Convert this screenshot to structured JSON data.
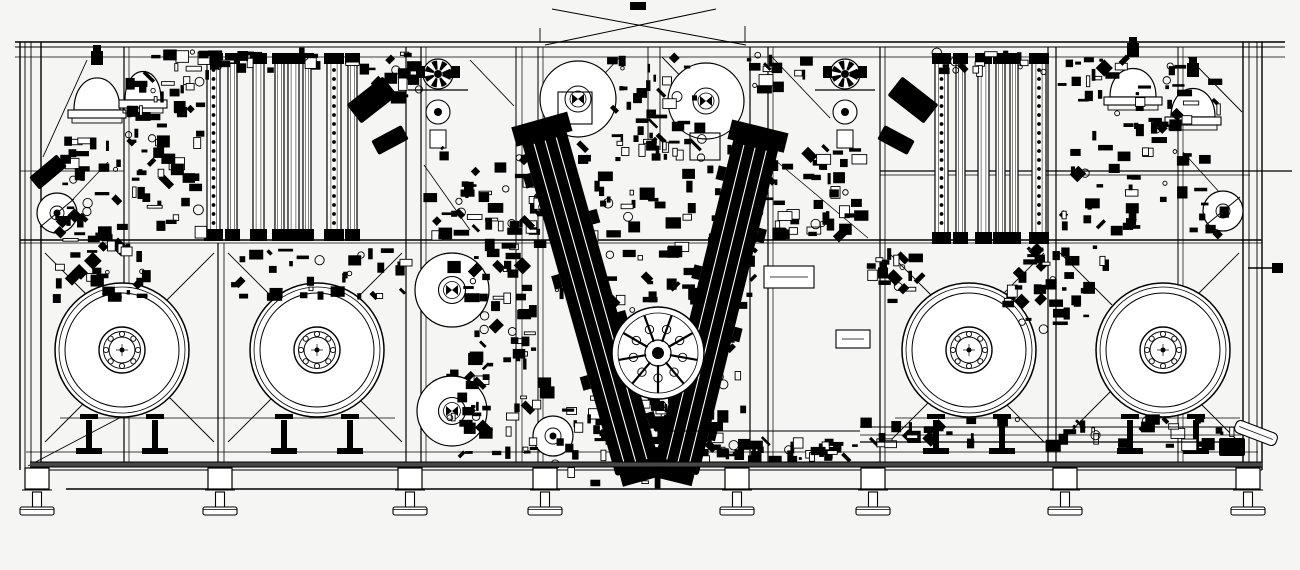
{
  "drawing": {
    "title": "machine-assembly-elevation-drawing",
    "canvas": {
      "w": 1300,
      "h": 570,
      "bg": "#f5f5f4",
      "ink": "#000000",
      "paper": "#ffffff",
      "beam": "#474747"
    },
    "frame": {
      "hlines": [
        [
          15,
          42,
          1285,
          42,
          1.6
        ],
        [
          15,
          47,
          1285,
          47,
          1.0
        ],
        [
          15,
          57,
          1285,
          57,
          0.8
        ],
        [
          20,
          240,
          1262,
          240,
          1.4
        ],
        [
          20,
          243,
          1262,
          243,
          0.8
        ],
        [
          26,
          452,
          1258,
          452,
          0.8
        ],
        [
          26,
          470,
          1262,
          470,
          1.0
        ],
        [
          66,
          489,
          1250,
          489,
          1.4
        ],
        [
          880,
          171,
          1292,
          171,
          1.2
        ],
        [
          880,
          175,
          1250,
          175,
          0.8
        ],
        [
          20,
          171,
          124,
          171,
          0.8
        ],
        [
          60,
          418,
          395,
          418,
          0.8
        ],
        [
          895,
          418,
          1240,
          418,
          0.8
        ],
        [
          1248,
          268,
          1274,
          268,
          1.4
        ]
      ],
      "posts": [
        [
          20,
          42,
          470,
          1.4
        ],
        [
          25,
          42,
          470,
          0.9
        ],
        [
          31,
          42,
          470,
          0.9
        ],
        [
          41,
          42,
          470,
          1.4
        ],
        [
          124,
          47,
          462,
          1.2
        ],
        [
          129,
          47,
          462,
          0.7
        ],
        [
          218,
          243,
          462,
          1.2
        ],
        [
          224,
          243,
          462,
          0.8
        ],
        [
          406,
          47,
          462,
          1.2
        ],
        [
          421,
          47,
          462,
          1.2
        ],
        [
          426,
          47,
          462,
          0.7
        ],
        [
          516,
          47,
          462,
          1.0
        ],
        [
          522,
          47,
          462,
          0.7
        ],
        [
          538,
          47,
          462,
          1.0
        ],
        [
          543,
          47,
          462,
          0.7
        ],
        [
          648,
          47,
          150,
          0.9
        ],
        [
          660,
          47,
          150,
          0.9
        ],
        [
          750,
          47,
          462,
          1.2
        ],
        [
          768,
          47,
          462,
          1.2
        ],
        [
          773,
          47,
          462,
          0.7
        ],
        [
          880,
          47,
          462,
          1.2
        ],
        [
          885,
          47,
          462,
          0.8
        ],
        [
          1048,
          47,
          462,
          1.2
        ],
        [
          1056,
          47,
          462,
          1.2
        ],
        [
          1178,
          47,
          462,
          1.0
        ],
        [
          1183,
          47,
          462,
          0.7
        ],
        [
          1243,
          42,
          470,
          1.4
        ],
        [
          1249,
          42,
          470,
          0.9
        ],
        [
          1257,
          42,
          470,
          0.9
        ],
        [
          1262,
          42,
          470,
          1.4
        ],
        [
          540,
          28,
          42,
          0.9
        ],
        [
          745,
          26,
          42,
          0.9
        ]
      ],
      "diagonals": [
        [
          620,
          57,
          532,
          152,
          0.9
        ],
        [
          662,
          57,
          754,
          152,
          0.9
        ],
        [
          470,
          60,
          514,
          106,
          0.9
        ],
        [
          424,
          165,
          470,
          230,
          0.8
        ],
        [
          772,
          57,
          830,
          118,
          0.9
        ],
        [
          775,
          160,
          868,
          238,
          0.8
        ],
        [
          43,
          157,
          87,
          60,
          0.9
        ],
        [
          46,
          228,
          108,
          162,
          0.8
        ],
        [
          1188,
          57,
          1242,
          112,
          0.9
        ],
        [
          1183,
          152,
          1240,
          215,
          0.8
        ],
        [
          28,
          466,
          150,
          402,
          0.9
        ]
      ],
      "top_x": [
        [
          545,
          45,
          716,
          9,
          1.0
        ],
        [
          552,
          9,
          746,
          45,
          1.0
        ]
      ]
    },
    "reel_bays": {
      "list": [
        [
          41,
          218
        ],
        [
          224,
          406
        ],
        [
          885,
          1048
        ],
        [
          1056,
          1243
        ]
      ],
      "y_top": 243,
      "y_bot": 452,
      "brace": 52
    },
    "reel_style": {
      "rings": [
        [
          67,
          1.5
        ],
        [
          63,
          0.8
        ],
        [
          57,
          1.0
        ]
      ],
      "hub": [
        [
          23,
          1.4
        ],
        [
          18.5,
          0.9
        ],
        [
          13,
          1.0
        ]
      ],
      "bolt_r": 2.6,
      "bolt_ring": 16,
      "bolts": 8
    },
    "reels": [
      {
        "name": "large-reel-1",
        "cx": 122,
        "cy": 350
      },
      {
        "name": "large-reel-2",
        "cx": 317,
        "cy": 350
      },
      {
        "name": "large-reel-3",
        "cx": 969,
        "cy": 350
      },
      {
        "name": "large-reel-4",
        "cx": 1163,
        "cy": 350
      }
    ],
    "stands_dx": 33,
    "rolls": [
      {
        "name": "guide-roll-top-left",
        "cx": 578,
        "cy": 99,
        "r": 38,
        "rings": [
          [
            13,
            1.0
          ],
          [
            8,
            0.8
          ]
        ],
        "hub": "bowtie",
        "box": [
          558,
          92,
          34,
          32
        ]
      },
      {
        "name": "guide-roll-top-right",
        "cx": 706,
        "cy": 101,
        "r": 38,
        "rings": [
          [
            13,
            1.0
          ],
          [
            8,
            0.8
          ]
        ],
        "hub": "bowtie",
        "box": [
          690,
          133,
          30,
          27
        ]
      },
      {
        "name": "material-roll-upper",
        "cx": 452,
        "cy": 290,
        "r": 37,
        "rings": [
          [
            13.5,
            1.1
          ],
          [
            8.5,
            0.8
          ]
        ],
        "hub": "bowtie"
      },
      {
        "name": "material-roll-lower",
        "cx": 452,
        "cy": 411,
        "r": 35,
        "rings": [
          [
            13.5,
            1.1
          ],
          [
            8.5,
            0.8
          ]
        ],
        "hub": "bowtie"
      },
      {
        "name": "small-roll-center",
        "cx": 553,
        "cy": 436,
        "r": 20,
        "rings": [
          [
            8,
            0.9
          ]
        ],
        "hub": "dot"
      },
      {
        "name": "tension-wheel-left",
        "cx": 57,
        "cy": 213,
        "r": 20,
        "rings": [
          [
            7,
            0.9
          ]
        ],
        "hub": "dot",
        "diag": true
      },
      {
        "name": "tension-wheel-right",
        "cx": 1223,
        "cy": 211,
        "r": 20,
        "rings": [
          [
            7,
            0.9
          ]
        ],
        "hub": "dot",
        "diag": true
      }
    ],
    "columns": {
      "left": {
        "y": 58,
        "h": 177,
        "list": [
          [
            207,
            13,
            true
          ],
          [
            228,
            9,
            false
          ],
          [
            253,
            11,
            false
          ],
          [
            275,
            9,
            false
          ],
          [
            288,
            11,
            false
          ],
          [
            303,
            8,
            false
          ],
          [
            327,
            14,
            true
          ],
          [
            348,
            9,
            false
          ]
        ]
      },
      "right": {
        "y": 58,
        "h": 180,
        "list": [
          [
            935,
            13,
            true
          ],
          [
            956,
            9,
            false
          ],
          [
            978,
            11,
            false
          ],
          [
            996,
            9,
            false
          ],
          [
            1010,
            8,
            false
          ],
          [
            1032,
            14,
            true
          ]
        ]
      }
    },
    "domes": [
      {
        "name": "dome-vessel-left-1",
        "cx": 97,
        "base": 110,
        "w": 46,
        "h": 45,
        "nozzle": true
      },
      {
        "name": "dome-vessel-left-2",
        "cx": 143,
        "base": 100,
        "w": 36,
        "h": 40,
        "nozzle": false
      },
      {
        "name": "dome-vessel-right-1",
        "cx": 1133,
        "base": 97,
        "w": 46,
        "h": 40,
        "nozzle": true
      },
      {
        "name": "dome-vessel-right-2",
        "cx": 1193,
        "base": 117,
        "w": 44,
        "h": 40,
        "nozzle": true
      }
    ],
    "pulleys": [
      {
        "cx": 438,
        "cy": 74
      },
      {
        "cx": 845,
        "cy": 74
      }
    ],
    "varms": [
      {
        "name": "v-arm-left",
        "x1": 543,
        "y1": 133,
        "x2": 638,
        "y2": 470,
        "w": 46
      },
      {
        "name": "v-arm-right",
        "x1": 757,
        "y1": 140,
        "x2": 676,
        "y2": 470,
        "w": 46
      }
    ],
    "turret": {
      "name": "process-turret",
      "cx": 658,
      "cy": 353,
      "r": 46,
      "spokes": 9
    },
    "actuators": [
      {
        "cx": 372,
        "cy": 100,
        "w": 46,
        "h": 24,
        "rot": -38
      },
      {
        "cx": 390,
        "cy": 140,
        "w": 34,
        "h": 16,
        "rot": -28
      },
      {
        "cx": 913,
        "cy": 100,
        "w": 46,
        "h": 24,
        "rot": 38
      },
      {
        "cx": 896,
        "cy": 140,
        "w": 34,
        "h": 16,
        "rot": 28
      },
      {
        "cx": 48,
        "cy": 172,
        "w": 36,
        "h": 16,
        "rot": -40
      },
      {
        "cx": 1232,
        "cy": 447,
        "w": 26,
        "h": 18,
        "rot": 0
      }
    ],
    "wboxes": [
      {
        "x": 764,
        "y": 266,
        "w": 50,
        "h": 22
      },
      {
        "x": 836,
        "y": 330,
        "w": 34,
        "h": 18
      }
    ],
    "bboxes": [
      {
        "x": 630,
        "y": 2,
        "w": 16,
        "h": 8
      },
      {
        "x": 1272,
        "y": 263,
        "w": 11,
        "h": 10
      }
    ],
    "clutter": [
      {
        "x": 58,
        "y": 138,
        "w": 150,
        "h": 102,
        "n": 70,
        "seed": 1
      },
      {
        "x": 128,
        "y": 52,
        "w": 80,
        "h": 88,
        "n": 38,
        "seed": 2
      },
      {
        "x": 360,
        "y": 52,
        "w": 62,
        "h": 46,
        "n": 16,
        "seed": 3
      },
      {
        "x": 428,
        "y": 140,
        "w": 118,
        "h": 98,
        "n": 55,
        "seed": 4
      },
      {
        "x": 448,
        "y": 244,
        "w": 100,
        "h": 212,
        "n": 85,
        "seed": 5
      },
      {
        "x": 556,
        "y": 138,
        "w": 200,
        "h": 165,
        "n": 115,
        "seed": 6
      },
      {
        "x": 585,
        "y": 295,
        "w": 160,
        "h": 165,
        "n": 100,
        "seed": 7
      },
      {
        "x": 555,
        "y": 408,
        "w": 130,
        "h": 75,
        "n": 45,
        "seed": 8
      },
      {
        "x": 756,
        "y": 148,
        "w": 108,
        "h": 92,
        "n": 48,
        "seed": 9
      },
      {
        "x": 744,
        "y": 52,
        "w": 68,
        "h": 38,
        "n": 14,
        "seed": 10
      },
      {
        "x": 1062,
        "y": 58,
        "w": 168,
        "h": 178,
        "n": 88,
        "seed": 11
      },
      {
        "x": 1008,
        "y": 244,
        "w": 98,
        "h": 88,
        "n": 42,
        "seed": 12
      },
      {
        "x": 862,
        "y": 416,
        "w": 375,
        "h": 30,
        "n": 48,
        "seed": 13
      },
      {
        "x": 52,
        "y": 246,
        "w": 100,
        "h": 58,
        "n": 30,
        "seed": 14
      },
      {
        "x": 230,
        "y": 250,
        "w": 180,
        "h": 48,
        "n": 34,
        "seed": 15
      },
      {
        "x": 868,
        "y": 250,
        "w": 55,
        "h": 55,
        "n": 20,
        "seed": 16
      },
      {
        "x": 205,
        "y": 52,
        "w": 160,
        "h": 20,
        "n": 18,
        "seed": 17
      },
      {
        "x": 930,
        "y": 52,
        "w": 125,
        "h": 20,
        "n": 16,
        "seed": 18
      },
      {
        "x": 612,
        "y": 56,
        "w": 92,
        "h": 100,
        "n": 40,
        "seed": 22
      },
      {
        "x": 685,
        "y": 440,
        "w": 175,
        "h": 22,
        "n": 40,
        "seed": 21
      }
    ],
    "legs": {
      "xs": [
        37,
        220,
        410,
        545,
        737,
        873,
        1065,
        1248
      ]
    },
    "base_beam": {
      "x": 30,
      "y": 462,
      "w": 1232,
      "h": 5
    },
    "conveyor": {
      "lines": [
        [
          860,
          427,
          1245,
          427,
          1.0
        ],
        [
          860,
          435,
          1245,
          435,
          0.8
        ],
        [
          860,
          442,
          1245,
          442,
          1.3
        ],
        [
          655,
          431,
          860,
          431,
          1.0
        ]
      ]
    },
    "chute": {
      "cx": 1256,
      "cy": 433,
      "w": 44,
      "h": 13,
      "rot": 21
    }
  }
}
